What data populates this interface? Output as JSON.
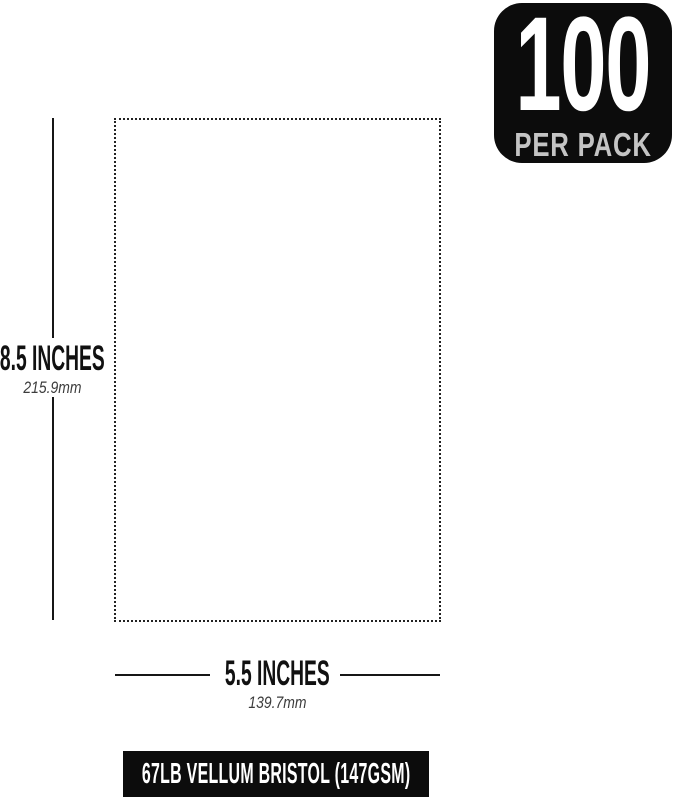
{
  "badge": {
    "count": "100",
    "label": "PER PACK",
    "background_color": "#0c0c0c",
    "count_color": "#ffffff",
    "label_color": "#c4c4c4"
  },
  "diagram": {
    "paper_outline": {
      "border_style": "dotted",
      "border_color": "#222222",
      "fill_color": "#ffffff"
    },
    "height_dimension": {
      "inches": "8.5 INCHES",
      "mm": "215.9mm"
    },
    "width_dimension": {
      "inches": "5.5 INCHES",
      "mm": "139.7mm"
    },
    "dimension_line_color": "#161616",
    "inches_text_color": "#111111",
    "metric_text_color": "#3c3c3c"
  },
  "footer": {
    "label": "67LB VELLUM BRISTOL (147GSM)",
    "background_color": "#0c0c0c",
    "text_color": "#ffffff"
  }
}
